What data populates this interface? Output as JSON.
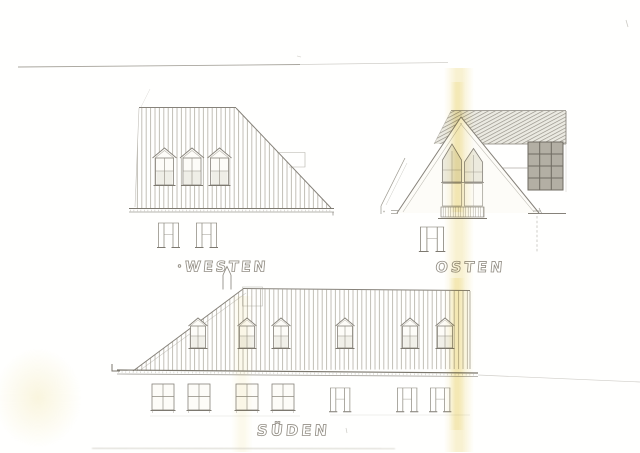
{
  "document": {
    "kind": "scanned pencil elevation drawing",
    "visible_text": [
      "WESTEN",
      "OSTEN",
      "SÜDEN"
    ]
  },
  "palette": {
    "paper": "#fdfcf8",
    "pencil_light": "#a19d91",
    "pencil": "#8f8b80",
    "pencil_dark": "#6f6b62",
    "stain_yellow": "#eedc8f",
    "glass_dark": "#b3afa4"
  },
  "elevations": {
    "west": {
      "label": "WESTEN",
      "bullet": "•",
      "dormers": 3,
      "ground_windows": 2
    },
    "east": {
      "label": "OSTEN",
      "ground_windows": 1
    },
    "south": {
      "label": "SÜDEN",
      "dormers": 6,
      "ground_windows": 7
    }
  }
}
